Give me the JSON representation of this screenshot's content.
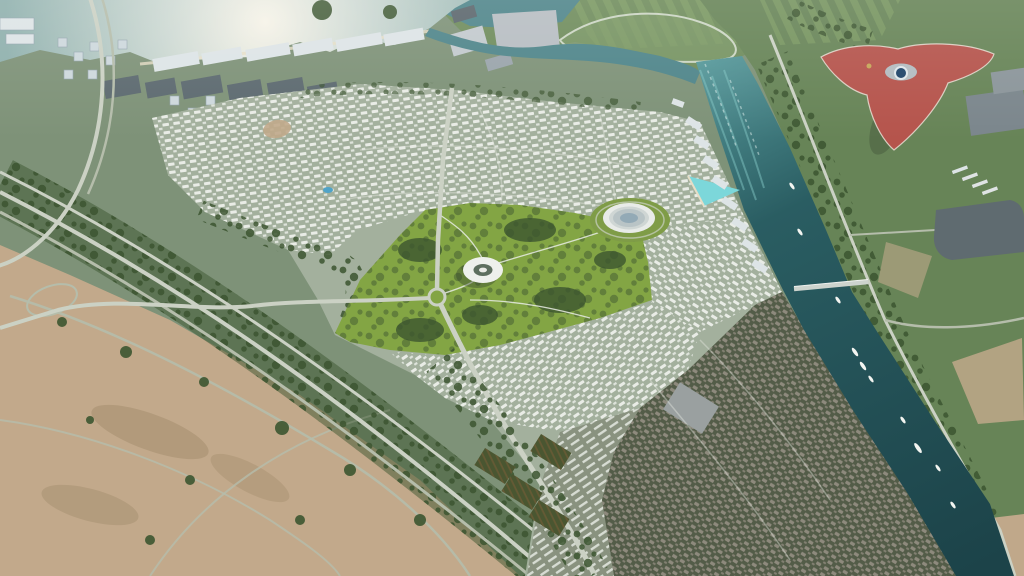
{
  "scene": {
    "description": "Aerial render of a riverside master-planned villa community with central park, two circular landmark buildings, a teal canal with boats, a red tri-star theme-park roof, coastal city blocks, highways and desert lots",
    "landmarks": {
      "theme_park_roof": "red three-armed star roof with blue funnel oculus",
      "park_torus_building": "white ring building in central park",
      "park_disc_building": "large concentric disc building on lawn",
      "canal": "teal canal with leisure boats",
      "bridge": "single road bridge over canal",
      "sun_glint_sea": "bright sun-glint water, top left"
    },
    "counts": {
      "boats": 10,
      "bridges": 1,
      "circular_buildings": 2,
      "star_roof_arms": 3
    }
  },
  "colors": {
    "groundBase": "#7e9278",
    "sea": "#8fb0ad",
    "glintCore": "#f6f3e8",
    "glintMid": "#cdd9d3",
    "river": "#4f858a",
    "canalTop": "#57999b",
    "canalMid": "#2a5d62",
    "canalDeep": "#1c4349",
    "canalStreak": "#7fc3c2",
    "rapids": "#dff0ee",
    "lagoon": "#7cd7da",
    "beach": "#e6ddc6",
    "citySlab": "#dde4e6",
    "citySide": "#9fb0b8",
    "tower": "#cdd8dc",
    "mall": "#5d6a70",
    "topField": "#6f8c5c",
    "rightField": "#678457",
    "fieldStripe": "#86a468",
    "trackGreen": "#7d9a68",
    "paved": "#b7bdc2",
    "warehouseA": "#c2c9cd",
    "warehouseB": "#9aa4ab",
    "warehouseC": "#5b666c",
    "villaBase": "#a3b09d",
    "villaRoof": "#e9ece6",
    "villaDarkBase": "#535c48",
    "villaDarkRoof": "#8e8a7d",
    "terraceBase": "#89927f",
    "terraceRoof": "#d7dcd3",
    "park": "#83a544",
    "lawn": "#7f9c47",
    "treeDark": "#3c5530",
    "treeLight": "#527544",
    "desert": "#c2a98b",
    "desertShadow": "#a28c6c",
    "road": "#cbd1c4",
    "roadMinor": "#b5bdab",
    "roadFaint": "#e8ebe4",
    "ferrariRed": "#b5544c",
    "ferrariTrim": "#e9ded3",
    "funnelBlue": "#1f4468",
    "funnelRim": "#dfe7ea",
    "logoGold": "#c8b05a",
    "centerPad": "#b3bcc0",
    "discShell": "#e8ebe8",
    "discRing": "#b9c4c6",
    "discGlass": "#93aab6",
    "torusShell": "#eef0ec",
    "torusHole": "#5d6e5e",
    "arena": "#5f6b70",
    "slabNE": "#7b868c",
    "boat": "#f3f5f1",
    "bridge": "#cdd3cd",
    "orchard": "#4a5631",
    "orchardRow": "#6b5b36",
    "pool": "#4fa3c8",
    "lot": "#c0a88a",
    "warehouseSE": "#9aa0a0",
    "shadow": "#33402e"
  }
}
